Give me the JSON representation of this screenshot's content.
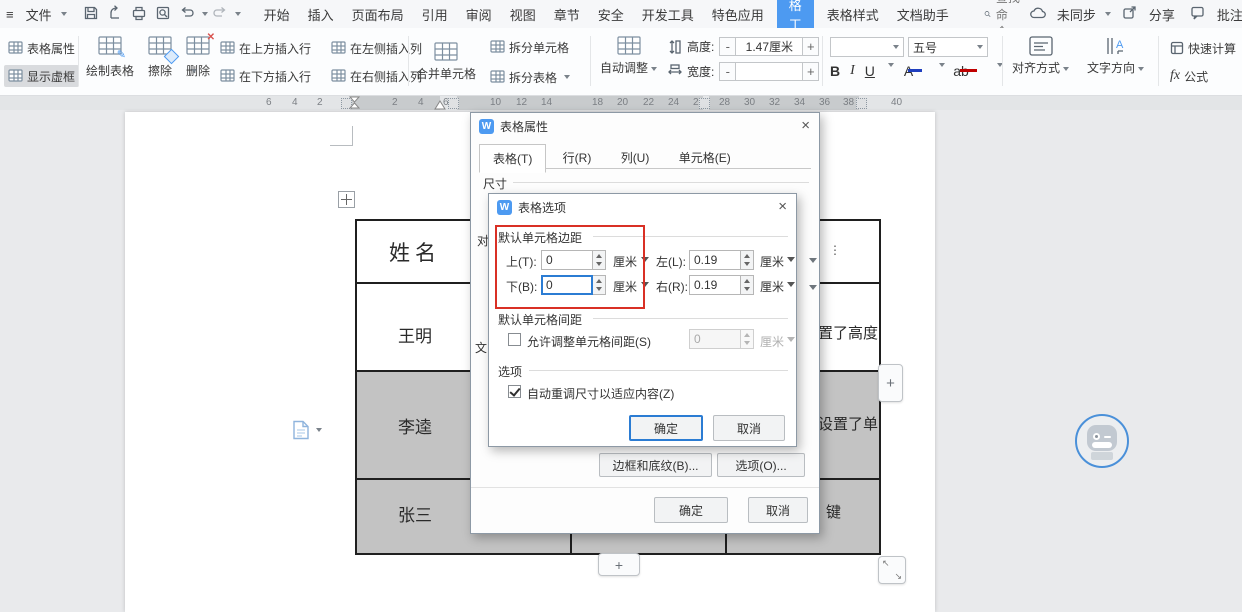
{
  "menubar": {
    "menu_icon": "≡",
    "file": "文件",
    "tabs": [
      "开始",
      "插入",
      "页面布局",
      "引用",
      "审阅",
      "视图",
      "章节",
      "安全",
      "开发工具",
      "特色应用"
    ],
    "tool_tab": "表格工具",
    "tabs_after": [
      "表格样式",
      "文档助手"
    ],
    "search": "查找命令...",
    "sync": "未同步",
    "share": "分享",
    "comment": "批注",
    "help": "?"
  },
  "toolbar": {
    "table_properties": "表格属性",
    "show_gridlines": "显示虚框",
    "draw_table": "绘制表格",
    "eraser": "擦除",
    "delete": "删除",
    "row_above": "在上方插入行",
    "row_below": "在下方插入行",
    "col_left": "在左侧插入列",
    "col_right": "在右侧插入列",
    "merge": "合并单元格",
    "split_cells": "拆分单元格",
    "split_table": "拆分表格",
    "autofit": "自动调整",
    "height": "高度:",
    "height_v": "1.47厘米",
    "width": "宽度:",
    "width_v": "",
    "minus": "-",
    "plus": "+",
    "font_size": "五号",
    "b": "B",
    "i": "I",
    "u": "U",
    "a": "A",
    "ab": "ab",
    "align": "对齐方式",
    "direction": "文字方向",
    "quick_calc": "快速计算",
    "fx": "fx",
    "formula": "公式"
  },
  "ruler": {
    "numbers": [
      {
        "label": "6",
        "x": 266
      },
      {
        "label": "4",
        "x": 292
      },
      {
        "label": "2",
        "x": 317
      },
      {
        "label": "2",
        "x": 392
      },
      {
        "label": "4",
        "x": 418
      },
      {
        "label": "6",
        "x": 443
      },
      {
        "label": "10",
        "x": 490
      },
      {
        "label": "12",
        "x": 516
      },
      {
        "label": "14",
        "x": 541
      },
      {
        "label": "18",
        "x": 592
      },
      {
        "label": "20",
        "x": 617
      },
      {
        "label": "22",
        "x": 643
      },
      {
        "label": "24",
        "x": 668
      },
      {
        "label": "26",
        "x": 693
      },
      {
        "label": "28",
        "x": 719
      },
      {
        "label": "30",
        "x": 744
      },
      {
        "label": "32",
        "x": 769
      },
      {
        "label": "34",
        "x": 794
      },
      {
        "label": "36",
        "x": 819
      },
      {
        "label": "38",
        "x": 843
      },
      {
        "label": "40",
        "x": 891
      }
    ]
  },
  "doc": {
    "names": [
      "姓名",
      "王明",
      "李逵",
      "张三"
    ],
    "frag_r1": "⋮",
    "frag_r2": "置了高度",
    "frag_r3": "设置了单",
    "frag_r4": "键",
    "plus": "+"
  },
  "props_dialog": {
    "logo": "W",
    "title": "表格属性",
    "close": "×",
    "tabs": [
      "表格(T)",
      "行(R)",
      "列(U)",
      "单元格(E)"
    ],
    "size": "尺寸",
    "frag1": "对",
    "frag2": "文",
    "borders": "边框和底纹(B)...",
    "options": "选项(O)...",
    "ok": "确定",
    "cancel": "取消"
  },
  "opts_dialog": {
    "logo": "W",
    "title": "表格选项",
    "close": "×",
    "margins": "默认单元格边距",
    "top": "上(T):",
    "top_v": "0",
    "bottom": "下(B):",
    "bottom_v": "0",
    "left": "左(L):",
    "left_v": "0.19",
    "right": "右(R):",
    "right_v": "0.19",
    "unit": "厘米",
    "spacing": "默认单元格间距",
    "allow": "允许调整单元格间距(S)",
    "allow_v": "0",
    "opts": "选项",
    "autofit": "自动重调尺寸以适应内容(Z)",
    "ok": "确定",
    "cancel": "取消"
  },
  "colors": {
    "accent": "#4d9af1",
    "annotation": "#d93025",
    "selected_cell": "#c3c3c3",
    "focus_border": "#2b7cd3"
  }
}
